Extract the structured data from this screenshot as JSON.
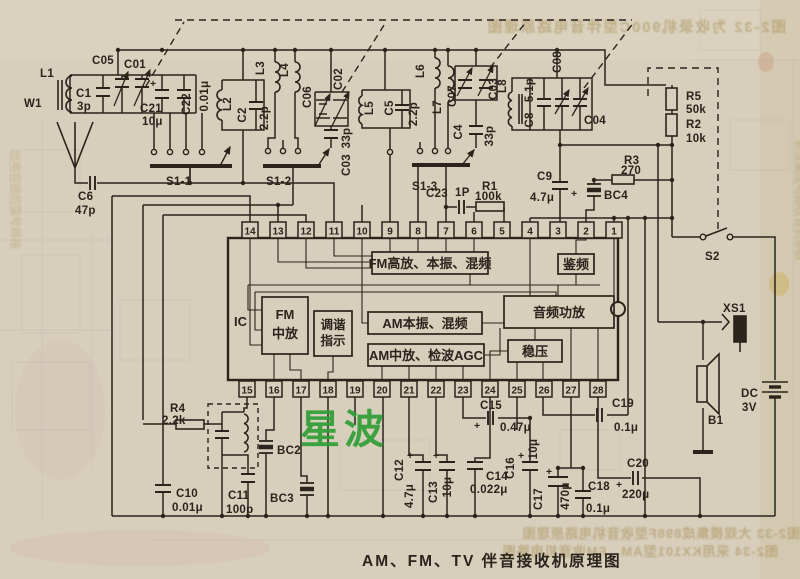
{
  "caption": "AM、FM、TV 伴音接收机原理图",
  "watermark": "星波",
  "colors": {
    "paper": "#d7cebb",
    "ink": "#2b241c",
    "watermark_green": "#2f9e35"
  },
  "ic": {
    "label": "IC",
    "top_pins": [
      "14",
      "13",
      "12",
      "11",
      "10",
      "9",
      "8",
      "7",
      "6",
      "5",
      "4",
      "3",
      "2",
      "1"
    ],
    "bottom_pins": [
      "15",
      "16",
      "17",
      "18",
      "19",
      "20",
      "21",
      "22",
      "23",
      "24",
      "25",
      "26",
      "27",
      "28"
    ]
  },
  "blk": {
    "fm_rf": "FM高放、本振、混频",
    "fm_if1": "FM",
    "fm_if2": "中放",
    "tun1": "调谐",
    "tun2": "指示",
    "am_osc": "AM本振、混频",
    "am_if": "AM中放、检波AGC",
    "disc": "鉴频",
    "audio": "音频功放",
    "reg": "稳压"
  },
  "t": {
    "w1": "W1",
    "l1": "L1",
    "c05": "C05",
    "c01": "C01",
    "c1": "C1",
    "c1v": "3p",
    "c21": "C21",
    "c21v": "10μ",
    "c22": "C22",
    "c22v": "0.01μ",
    "l2": "L2",
    "c2": "C2",
    "c2v": "2.2p",
    "s1_1": "S1-1",
    "c6": "C6",
    "c6v": "47p",
    "l3": "L3",
    "l4": "L4",
    "c06": "C06",
    "c02": "C02",
    "c03a": "C03",
    "c03av": "33p",
    "s1_2": "S1-2",
    "l5": "L5",
    "c5": "C5",
    "c5v": "2.2p",
    "l6": "L6",
    "l7": "L7",
    "c07": "C07",
    "c03b": "C03",
    "c4": "C4",
    "c4v": "33p",
    "s1_3": "S1-3",
    "l8": "L8",
    "c8": "C8",
    "c8v": "5.1p",
    "c08": "C08",
    "c04": "C04",
    "c23": "C23",
    "c23v": "1P",
    "r1": "R1",
    "r1v": "100k",
    "r5": "R5",
    "r5v": "50k",
    "r2": "R2",
    "r2v": "10k",
    "r3": "R3",
    "r3v": "270",
    "c9": "C9",
    "c9v": "4.7μ",
    "bc4": "BC4",
    "s2": "S2",
    "xs1": "XS1",
    "dc": "DC",
    "dcv": "3V",
    "b1": "B1",
    "ic": "IC",
    "r4": "R4",
    "r4v": "2.2k",
    "bc2": "BC2",
    "bc3": "BC3",
    "c10": "C10",
    "c10v": "0.01μ",
    "c11": "C11",
    "c11v": "100p",
    "c12": "C12",
    "c12v": "4.7μ",
    "c13": "C13",
    "c13v": "10μ",
    "c14": "C14",
    "c14v": "0.022μ",
    "c15": "C15",
    "c15v": "0.47μ",
    "c16": "C16",
    "c16v": "10μ",
    "c17": "C17",
    "c17v": "470μ",
    "c18": "C18",
    "c18v": "0.1μ",
    "c19": "C19",
    "c19v": "0.1μ",
    "c20": "C20",
    "c20v": "220μ",
    "plus": "+"
  },
  "bleed": {
    "top": "图2-32 为收录机900C型伴音电路原理图",
    "bottom1": "图2-33 大规模集成898F型收音机电路原理图",
    "bottom2": "图2-34 采用KX101型AM、FM收音机电路图",
    "side_right": "新型集成电路收音机参数",
    "side_left": "出电容器的型号规格"
  }
}
